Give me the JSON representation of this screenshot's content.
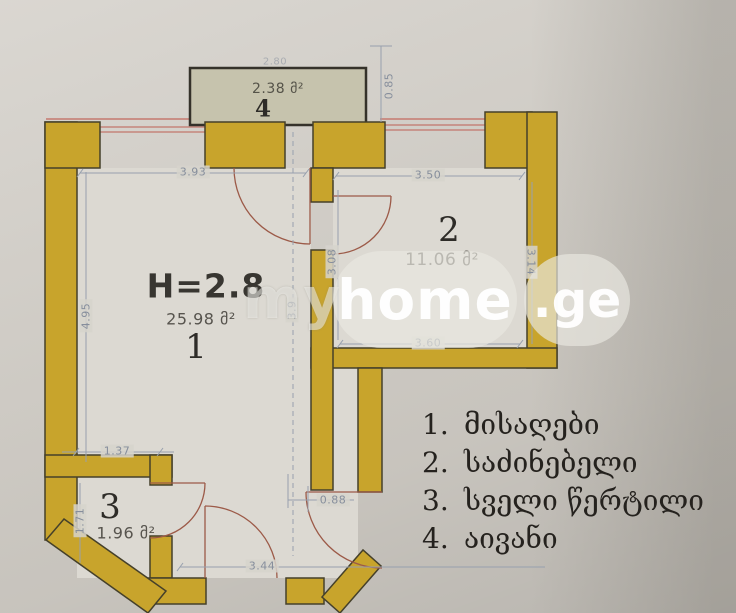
{
  "watermark": {
    "part1": "my",
    "part2": "home",
    "part3": ".ge"
  },
  "rooms": {
    "r1": {
      "label": "1",
      "area": "25.98 მ²",
      "height_note": "H=2.8"
    },
    "r2": {
      "label": "2",
      "area": "11.06 მ²"
    },
    "r3": {
      "label": "3",
      "area": "1.96 მ²"
    },
    "r4": {
      "label": "4",
      "area": "2.38 მ²"
    }
  },
  "dims": {
    "top_left": "3.93",
    "top_right": "3.50",
    "left": "4.95",
    "right": "3.14",
    "room2_left": "3.08",
    "room2_bottom": "3.60",
    "middle": "3.9",
    "niche": "1.37",
    "room3_left": "1.71",
    "offset": "0.88",
    "bottom": "3.44",
    "balcony_width": "2.80",
    "balcony_depth": "0.85"
  },
  "legend": {
    "items": [
      {
        "num": "1.",
        "label": "მისაღები"
      },
      {
        "num": "2.",
        "label": "საძინებელი"
      },
      {
        "num": "3.",
        "label": "სველი წერტილი"
      },
      {
        "num": "4.",
        "label": "აივანი"
      }
    ]
  },
  "colors": {
    "wall": "#c8a42c",
    "wall_outline": "#45402a",
    "balcony_fill": "#c6c3ad",
    "interior": "#dcd9d2",
    "dimension": "#868e9c",
    "door": "#9c5a48",
    "window": "#c2766b",
    "legend_text": "#25221e"
  }
}
